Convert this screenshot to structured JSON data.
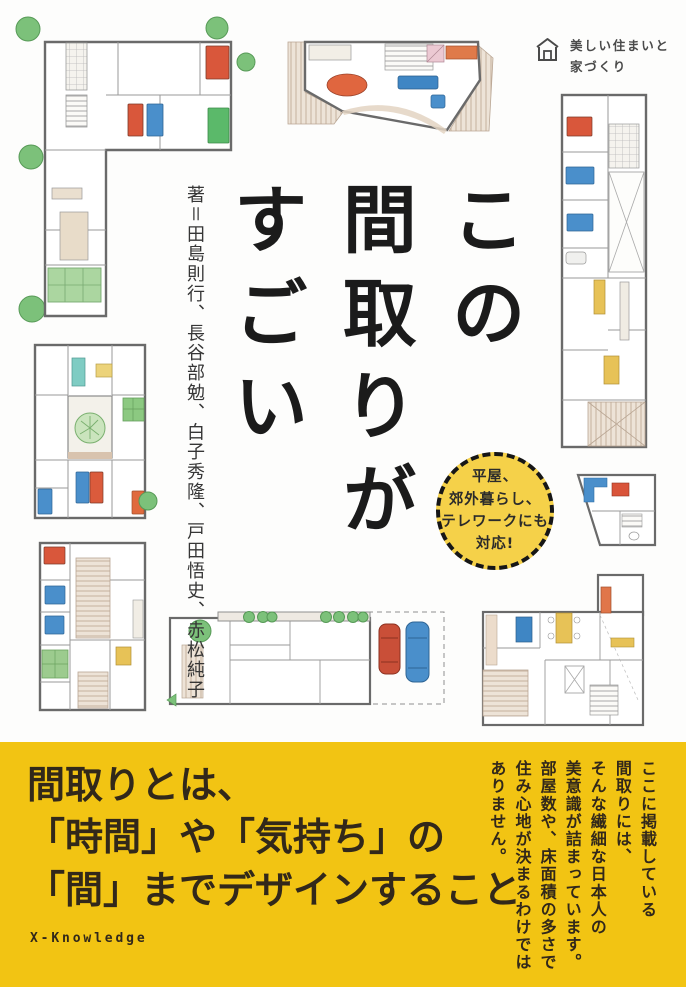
{
  "cover": {
    "publisher_logo": "美しい住まいと\n家づくり",
    "title": "この\n間取りが\nすごい",
    "author_credit": "著＝田島則行、長谷部勉、白子秀隆、戸田悟史、赤松純子",
    "badge_text": "平屋、\n郊外暮らし、\nテレワークにも\n対応!",
    "band_headline": "間取りとは、\n「時間」や「気持ち」の\n「間」までデザインすること",
    "band_note_vertical": "ここに掲載している\n間取りには、\nそんな繊細な日本人の\n美意識が詰まっています。\n部屋数や、床面積の多さで\n住み心地が決まるわけでは\nありません。",
    "publisher_name": "X-Knowledge",
    "colors": {
      "band_yellow": "#F2C413",
      "badge_yellow": "#F5D149",
      "title_black": "#1B1B1B",
      "band_text_dark": "#32281A",
      "plan_accent_red": "#D9573B",
      "plan_accent_blue": "#4A8FCB",
      "plan_accent_green": "#7CC17A",
      "plan_accent_yellow": "#E7C257",
      "plan_wall_gray": "#6A6A6A"
    }
  }
}
